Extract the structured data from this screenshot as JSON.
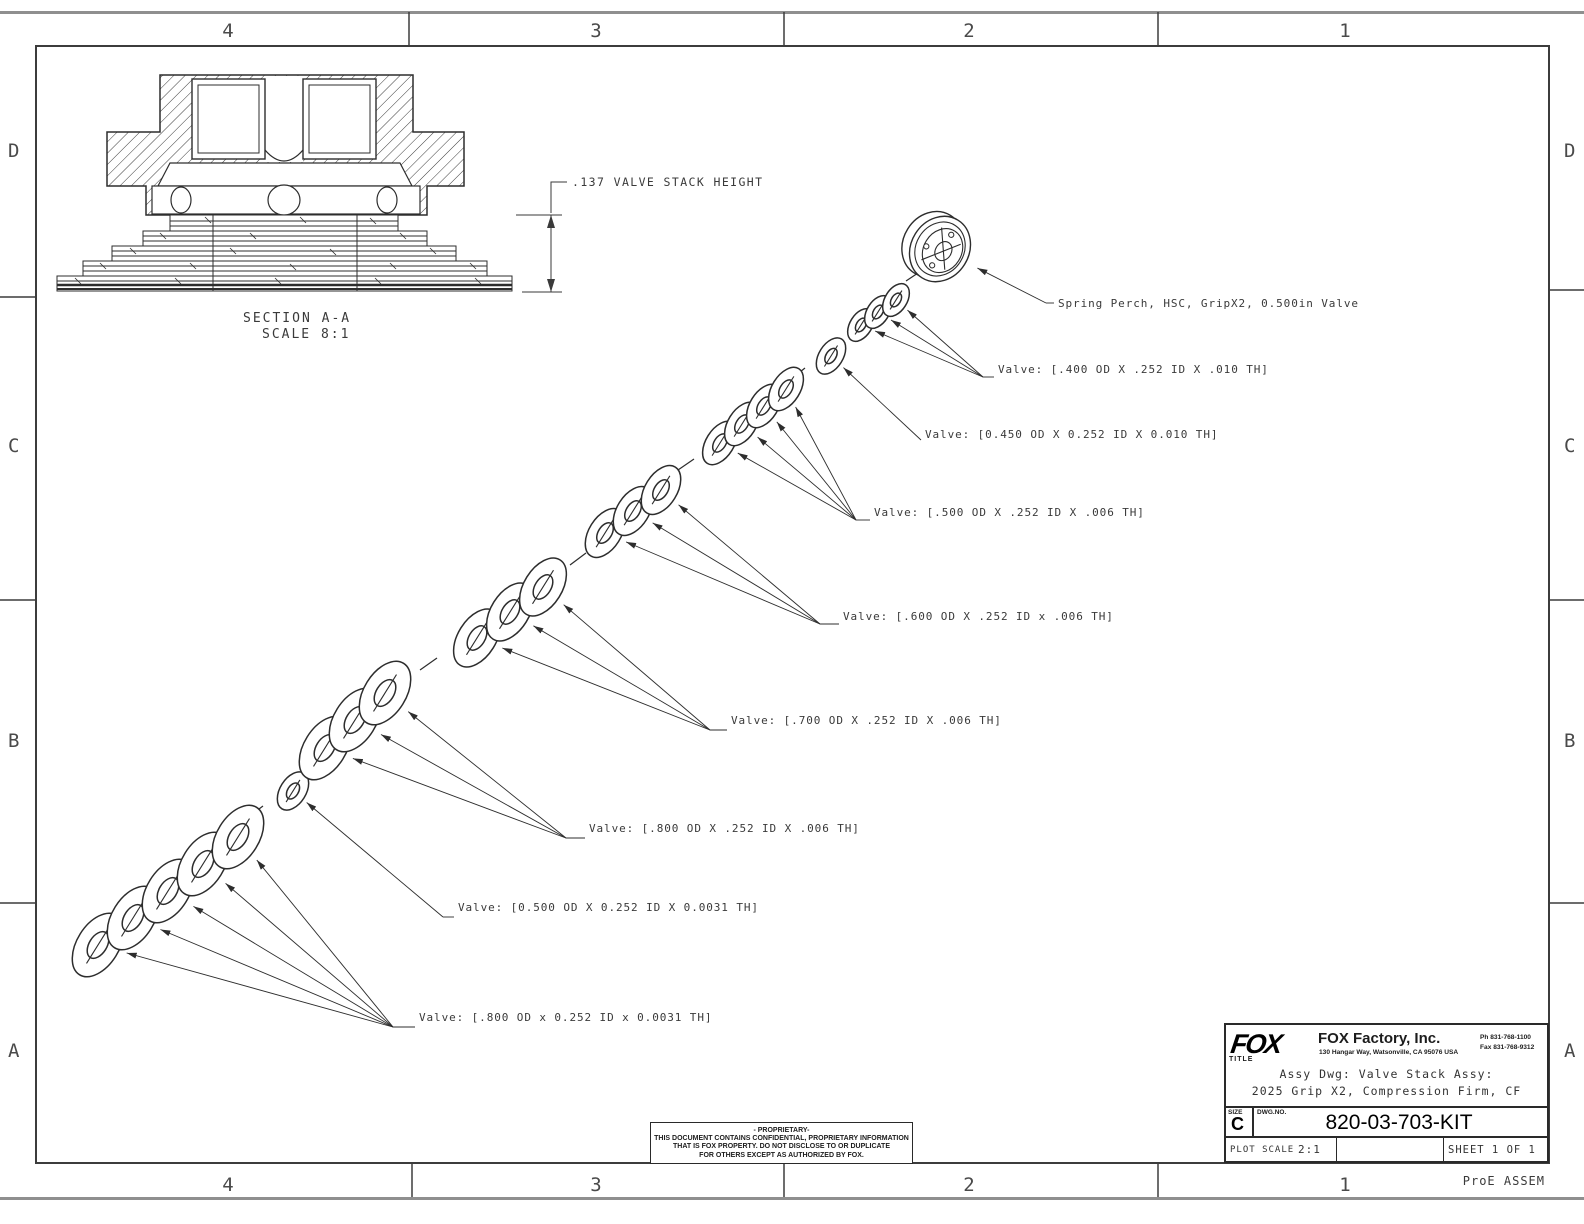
{
  "drawing": {
    "zones": {
      "cols": [
        "4",
        "3",
        "2",
        "1"
      ],
      "rows": [
        "D",
        "C",
        "B",
        "A"
      ]
    },
    "section_view": {
      "title": "SECTION A-A",
      "scale": "SCALE 8:1"
    },
    "dimension_note": ".137 VALVE STACK HEIGHT",
    "footer_note": "ProE ASSEM"
  },
  "exploded": {
    "groups": [
      {
        "id": "valve-800-0031",
        "label": "Valve: [.800 OD x 0.252 ID x 0.0031 TH]",
        "label_x": 419,
        "label_y": 1021,
        "elbow": [
          393,
          1027
        ],
        "size": [
          21,
          35
        ],
        "shims": [
          [
            98,
            945
          ],
          [
            133,
            918
          ],
          [
            168,
            891
          ],
          [
            203,
            864
          ],
          [
            238,
            837
          ]
        ]
      },
      {
        "id": "valve-500-0031",
        "label": "Valve: [0.500 OD X 0.252 ID X 0.0031 TH]",
        "label_x": 458,
        "label_y": 911,
        "elbow": [
          443,
          917
        ],
        "size": [
          13,
          21
        ],
        "shims": [
          [
            293,
            791
          ]
        ]
      },
      {
        "id": "valve-800-006",
        "label": "Valve: [.800 OD X .252 ID X .006 TH]",
        "label_x": 589,
        "label_y": 832,
        "elbow": [
          566,
          838
        ],
        "size": [
          21,
          35
        ],
        "shims": [
          [
            325,
            748
          ],
          [
            355,
            720
          ],
          [
            385,
            693
          ]
        ]
      },
      {
        "id": "valve-700-006",
        "label": "Valve: [.700 OD X .252 ID X .006 TH]",
        "label_x": 731,
        "label_y": 724,
        "elbow": [
          710,
          730
        ],
        "size": [
          19,
          32
        ],
        "shims": [
          [
            477,
            638
          ],
          [
            510,
            612
          ],
          [
            543,
            587
          ]
        ]
      },
      {
        "id": "valve-600-006",
        "label": "Valve: [.600 OD X .252 ID x .006 TH]",
        "label_x": 843,
        "label_y": 620,
        "elbow": [
          820,
          624
        ],
        "size": [
          16,
          27
        ],
        "shims": [
          [
            605,
            533
          ],
          [
            633,
            511
          ],
          [
            661,
            490
          ]
        ]
      },
      {
        "id": "valve-500-006",
        "label": "Valve: [.500 OD X .252 ID X .006 TH]",
        "label_x": 874,
        "label_y": 516,
        "elbow": [
          856,
          520
        ],
        "size": [
          14,
          24
        ],
        "shims": [
          [
            720,
            443
          ],
          [
            742,
            424
          ],
          [
            764,
            406
          ],
          [
            786,
            389
          ]
        ]
      },
      {
        "id": "valve-450-010",
        "label": "Valve: [0.450 OD X 0.252 ID X 0.010 TH]",
        "label_x": 925,
        "label_y": 438,
        "elbow": [
          921,
          440
        ],
        "size": [
          12,
          20
        ],
        "shims": [
          [
            831,
            356
          ]
        ]
      },
      {
        "id": "valve-400-010",
        "label": "Valve: [.400 OD X .252 ID X .010 TH]",
        "label_x": 998,
        "label_y": 373,
        "elbow": [
          983,
          377
        ],
        "size": [
          11,
          18
        ],
        "shims": [
          [
            861,
            325
          ],
          [
            878,
            312
          ],
          [
            896,
            300
          ]
        ]
      },
      {
        "id": "spring-perch",
        "label": "Spring Perch, HSC, GripX2, 0.500in Valve",
        "label_x": 1058,
        "label_y": 307,
        "elbow": [
          1046,
          303
        ],
        "perch": true,
        "shims": [
          [
            940,
            249
          ]
        ]
      }
    ],
    "axis_dashes": [
      [
        247,
        818,
        263,
        806
      ],
      [
        420,
        670,
        437,
        658
      ],
      [
        570,
        565,
        586,
        553
      ],
      [
        678,
        470,
        694,
        459
      ],
      [
        790,
        380,
        805,
        368
      ],
      [
        906,
        281,
        921,
        271
      ]
    ]
  },
  "title_block": {
    "logo": "FOX",
    "company": "FOX Factory, Inc.",
    "address": "130 Hangar Way, Watsonville, CA 95076 USA",
    "phone": "Ph 831-768-1100",
    "fax": "Fax 831-768-9312",
    "title_label": "TITLE",
    "title_line1": "Assy Dwg: Valve Stack Assy:",
    "title_line2": "2025 Grip X2, Compression Firm, CF",
    "size_label": "SIZE",
    "size_value": "C",
    "dwg_label": "DWG.NO.",
    "dwg_number": "820-03-703-KIT",
    "plot_scale_label": "PLOT SCALE",
    "plot_scale_value": "2:1",
    "sheet_label": "SHEET 1 OF 1"
  },
  "proprietary": {
    "line1": "- PROPRIETARY-",
    "line2": "THIS DOCUMENT CONTAINS CONFIDENTIAL, PROPRIETARY INFORMATION",
    "line3": "THAT IS FOX PROPERTY.  DO NOT DISCLOSE TO OR DUPLICATE",
    "line4": "FOR OTHERS EXCEPT AS AUTHORIZED BY FOX."
  }
}
